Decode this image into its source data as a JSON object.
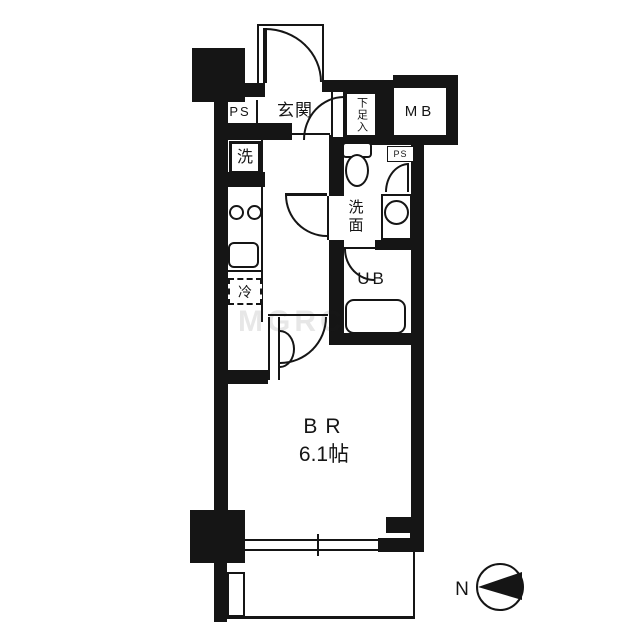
{
  "document": {
    "type": "japanese-apartment-floor-plan"
  },
  "labels": {
    "entrance": "玄関",
    "pipe_space_left": "PS",
    "pipe_space_right": "PS",
    "meter_box": "MB",
    "shoe_cabinet": "下足入",
    "washer": "洗",
    "washroom": "洗面",
    "unit_bath": "UB",
    "fridge": "冷",
    "bedroom": "BR",
    "bedroom_size": "6.1帖",
    "compass_north": "N",
    "watermark": "MGRC"
  },
  "colors": {
    "wall": "#151515",
    "background": "#ffffff"
  }
}
